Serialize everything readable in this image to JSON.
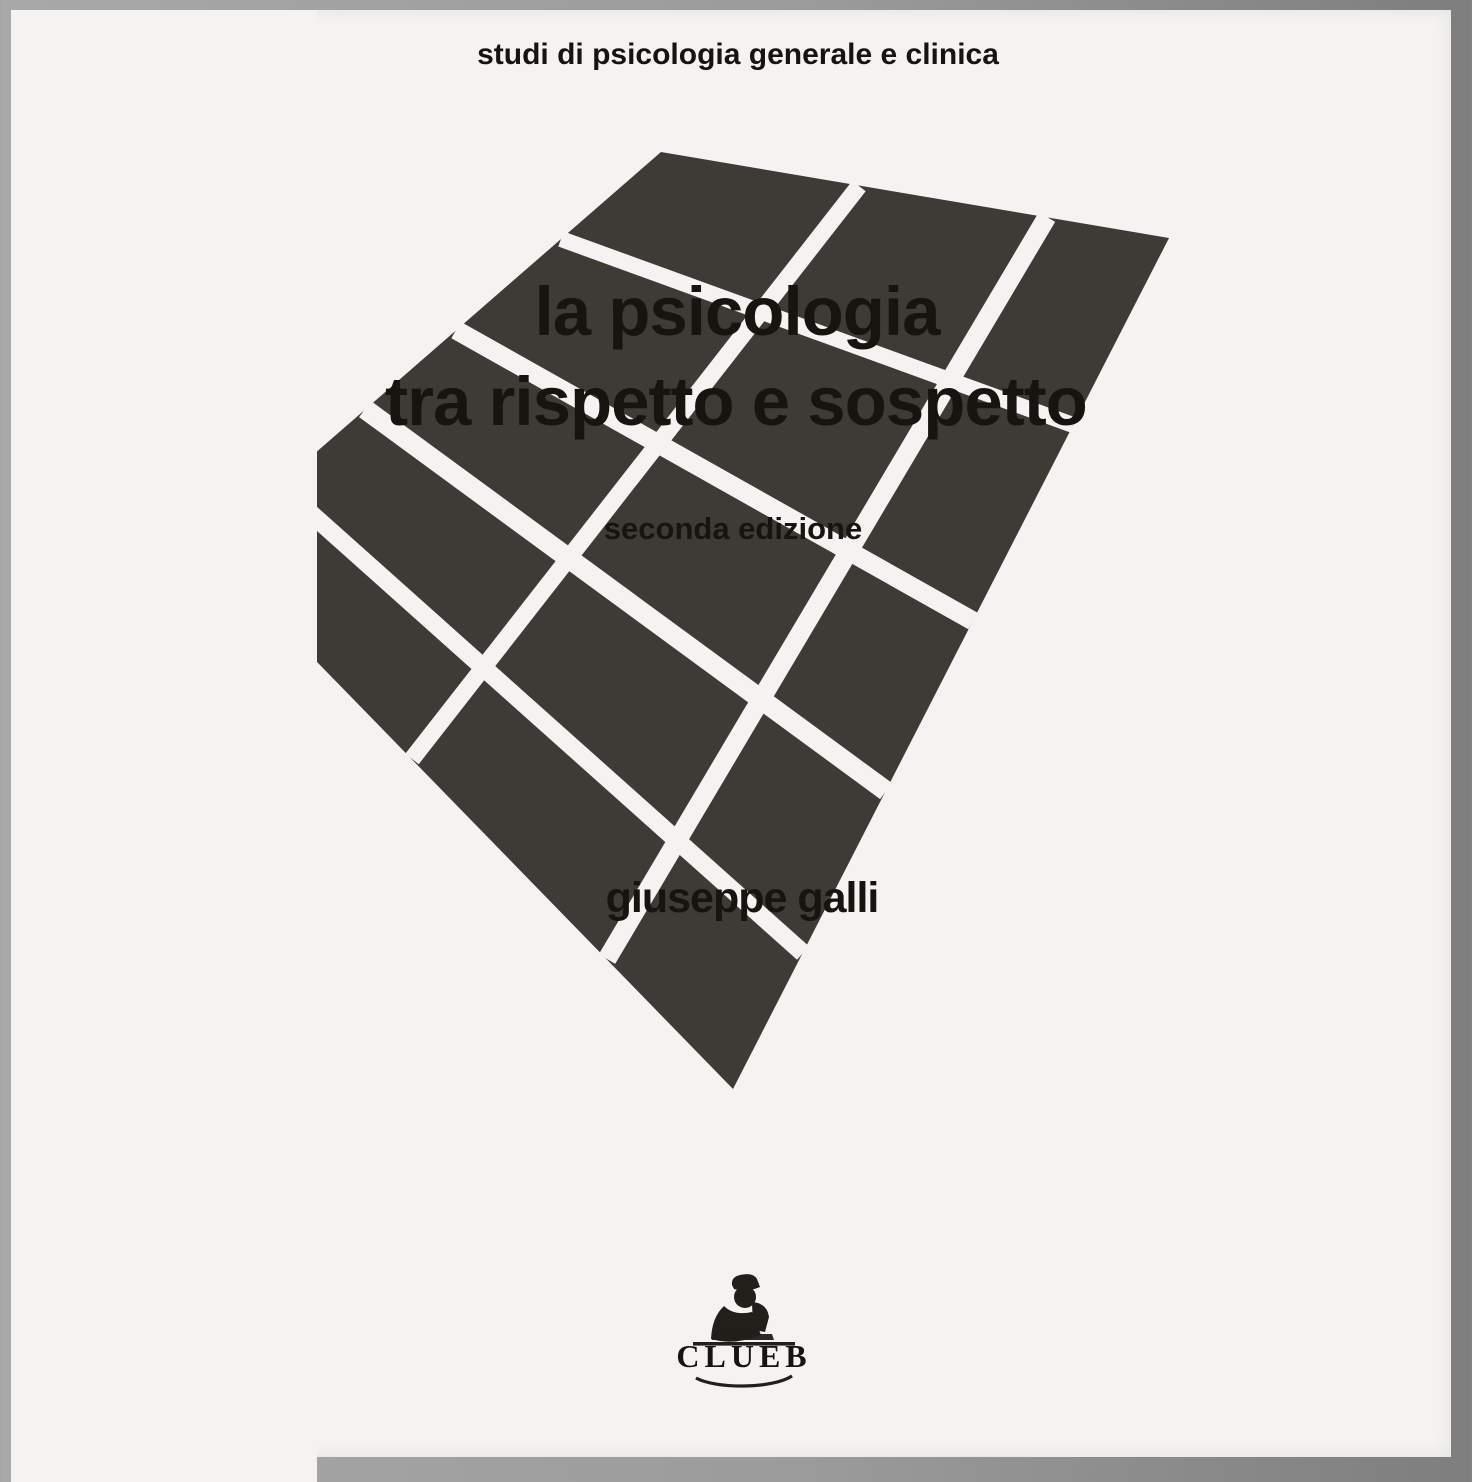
{
  "cover": {
    "series_title": "studi di psicologia generale e clinica",
    "title_line1": "la psicologia",
    "title_line2": "tra rispetto e sospetto",
    "edition": "seconda edizione",
    "author": "giuseppe galli",
    "publisher_name": "CLUEB"
  },
  "artwork": {
    "description": "perspective checkerboard of dark tiles converging to a point at bottom",
    "tile_color": "#3e3a35",
    "line_color": "#f4f3f1",
    "figure_color": "#221e1a"
  },
  "colors": {
    "paper": "#f4f3f1",
    "ink": "#17140f",
    "frame": "#8f8f8f"
  }
}
